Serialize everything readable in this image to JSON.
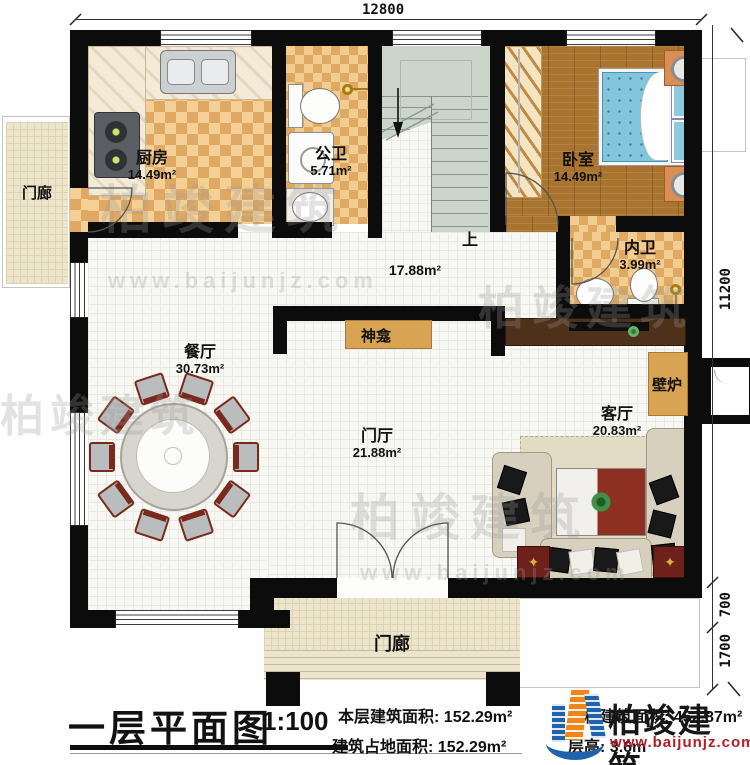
{
  "plan": {
    "rooms": [
      {
        "id": "kitchen",
        "name": "厨房",
        "area": "14.49m²"
      },
      {
        "id": "public-bath",
        "name": "公卫",
        "area": "5.71m²"
      },
      {
        "id": "bedroom",
        "name": "卧室",
        "area": "14.49m²"
      },
      {
        "id": "ensuite-bath",
        "name": "内卫",
        "area": "3.99m²"
      },
      {
        "id": "hallway",
        "name": "",
        "area": "17.88m²"
      },
      {
        "id": "dining",
        "name": "餐厅",
        "area": "30.73m²"
      },
      {
        "id": "foyer",
        "name": "门厅",
        "area": "21.88m²"
      },
      {
        "id": "living",
        "name": "客厅",
        "area": "20.83m²"
      }
    ],
    "features": {
      "shrine": "神龛",
      "fireplace": "壁炉",
      "porch_left": "门廊",
      "porch_bottom": "门廊",
      "stairs_up": "上"
    },
    "dimensions": {
      "top": "12800",
      "right_main": "11200",
      "right_eave": "700",
      "right_porch": "1700"
    }
  },
  "title_block": {
    "title": "一层平面图",
    "scale": "1:100",
    "floor_area_label": "本层建筑面积:",
    "floor_area_value": "152.29m²",
    "footprint_label": "建筑占地面积:",
    "footprint_value": "152.29m²",
    "total_area_label": "本栋建筑面积:",
    "total_area_value": "452.87m²",
    "height_label": "层高:",
    "height_value": "3.6m"
  },
  "logo": {
    "name": "柏竣建筑",
    "url": "www.baijunjz.com"
  },
  "watermark": {
    "brand": "柏竣建筑",
    "site": "www.baijunjz.com"
  }
}
